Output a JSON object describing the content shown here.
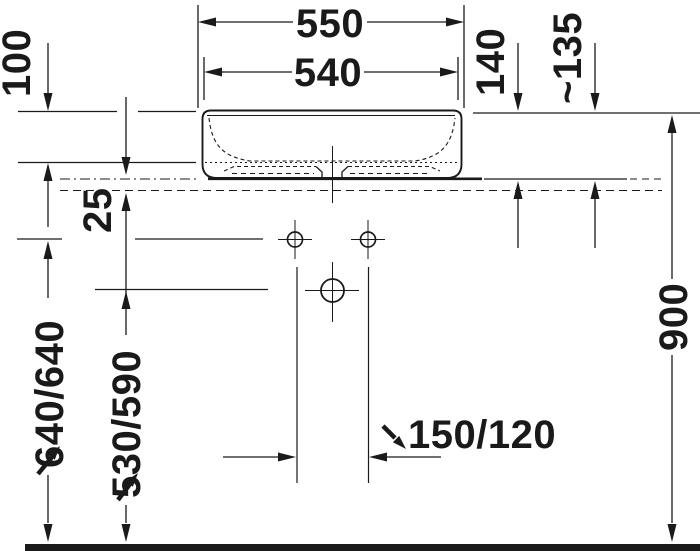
{
  "meta": {
    "drawing_type": "technical-dimension-drawing",
    "subject": "countertop washbasin front view with console and connection heights",
    "units_implied": "mm"
  },
  "colors": {
    "background": "#ffffff",
    "line": "#1a1a1a"
  },
  "dimensions": {
    "overall_width": "550",
    "inner_width": "540",
    "bowl_depth": "100",
    "console_thickness": "25",
    "basin_height_above_console": "140",
    "height_approx": "~135",
    "supply_connection_height": "640/640",
    "drain_connection_height": "530/590",
    "tap_hole_distance": "150/120",
    "rim_height_above_floor": "900"
  }
}
